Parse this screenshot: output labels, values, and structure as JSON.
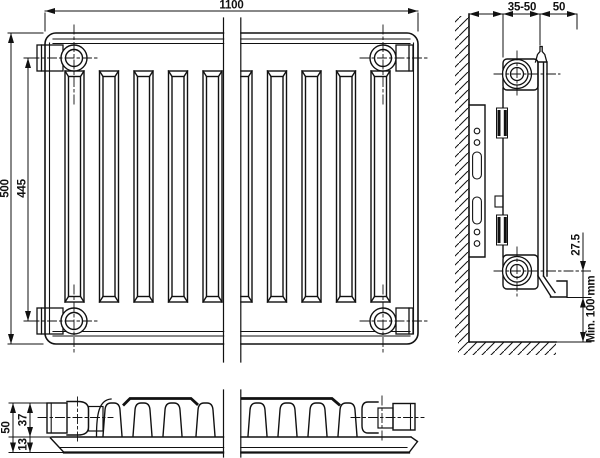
{
  "colors": {
    "line": "#111111",
    "background": "#ffffff"
  },
  "dimensions": {
    "front": {
      "width": "1100",
      "height": "500",
      "hub_distance": "445"
    },
    "side": {
      "wall_gap": "35-50",
      "depth": "50",
      "hub_offset": "27.5",
      "floor_clearance": "Min. 100 mm"
    },
    "bottom": {
      "total_depth": "50",
      "convector_depth": "37",
      "panel_depth": "13"
    }
  }
}
